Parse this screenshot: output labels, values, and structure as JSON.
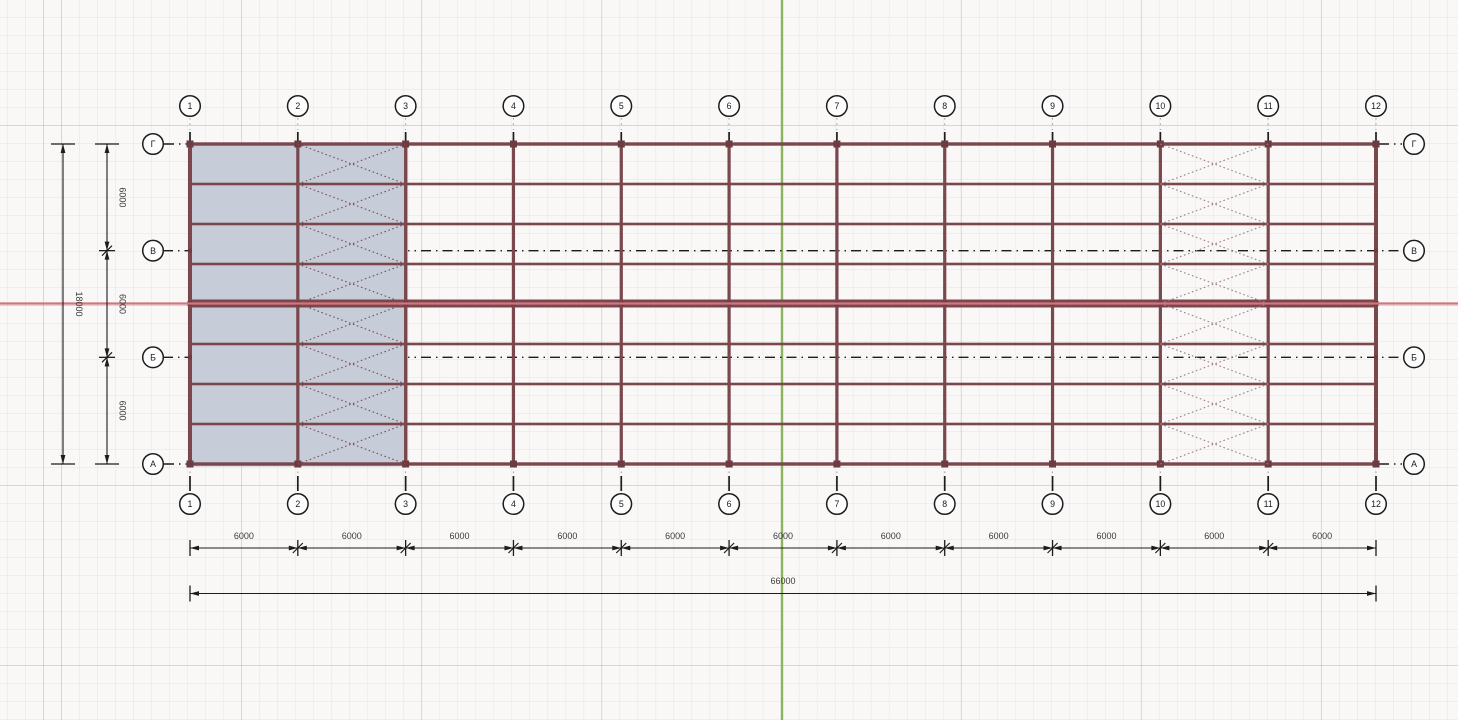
{
  "viewport": {
    "type": "cad-structural-plan",
    "column_grids": {
      "labels": [
        "1",
        "2",
        "3",
        "4",
        "5",
        "6",
        "7",
        "8",
        "9",
        "10",
        "11",
        "12"
      ]
    },
    "row_grids": {
      "labels_top_to_bottom": [
        "Г",
        "В",
        "Б",
        "А"
      ]
    },
    "dimensions": {
      "bottom_segments": [
        "6000",
        "6000",
        "6000",
        "6000",
        "6000",
        "6000",
        "6000",
        "6000",
        "6000",
        "6000",
        "6000"
      ],
      "bottom_total": "66000",
      "left_segments_top_to_bottom": [
        "6000",
        "6000",
        "6000"
      ],
      "left_total": "18000"
    },
    "braced_bays": [
      {
        "between_grids": "2-3",
        "state": "selected"
      },
      {
        "between_grids": "10-11",
        "state": "normal"
      }
    ],
    "selection": {
      "from_grid": "1",
      "to_grid": "3",
      "rows": "А-Г"
    },
    "colors": {
      "beam": "#7a474d",
      "beam_node": "#6d3c42",
      "selection_fill": "#c6cdd8",
      "brace_selected": "#7b4e55",
      "brace_normal": "#9c7e84",
      "origin_x_axis": "#d27583",
      "origin_y_axis": "#8cb45f",
      "annotation": "#1c1c1c",
      "annotation_faint": "#999999",
      "dim_text": "#3a3a3a",
      "bubble_fill": "#fdfdfd"
    }
  }
}
